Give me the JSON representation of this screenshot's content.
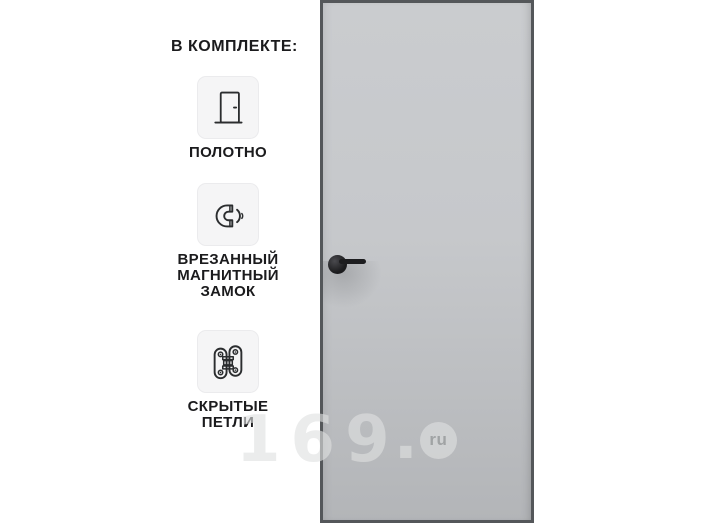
{
  "kit": {
    "heading": "В КОМПЛЕКТЕ:",
    "items": [
      {
        "icon": "door-leaf-icon",
        "label": "ПОЛОТНО"
      },
      {
        "icon": "magnetic-lock-icon",
        "label": "ВРЕЗАННЫЙ МАГНИТНЫЙ ЗАМОК"
      },
      {
        "icon": "hidden-hinges-icon",
        "label": "СКРЫТЫЕ ПЕТЛИ"
      }
    ]
  },
  "door": {
    "panel_color_top": "#cacccf",
    "panel_color_bottom": "#b3b5b8",
    "frame_color": "#54575a",
    "handle_color": "#1d1d1f"
  },
  "watermark": {
    "text": "169",
    "dot": ".",
    "suffix": "ru",
    "color": "#dfe0e1"
  }
}
